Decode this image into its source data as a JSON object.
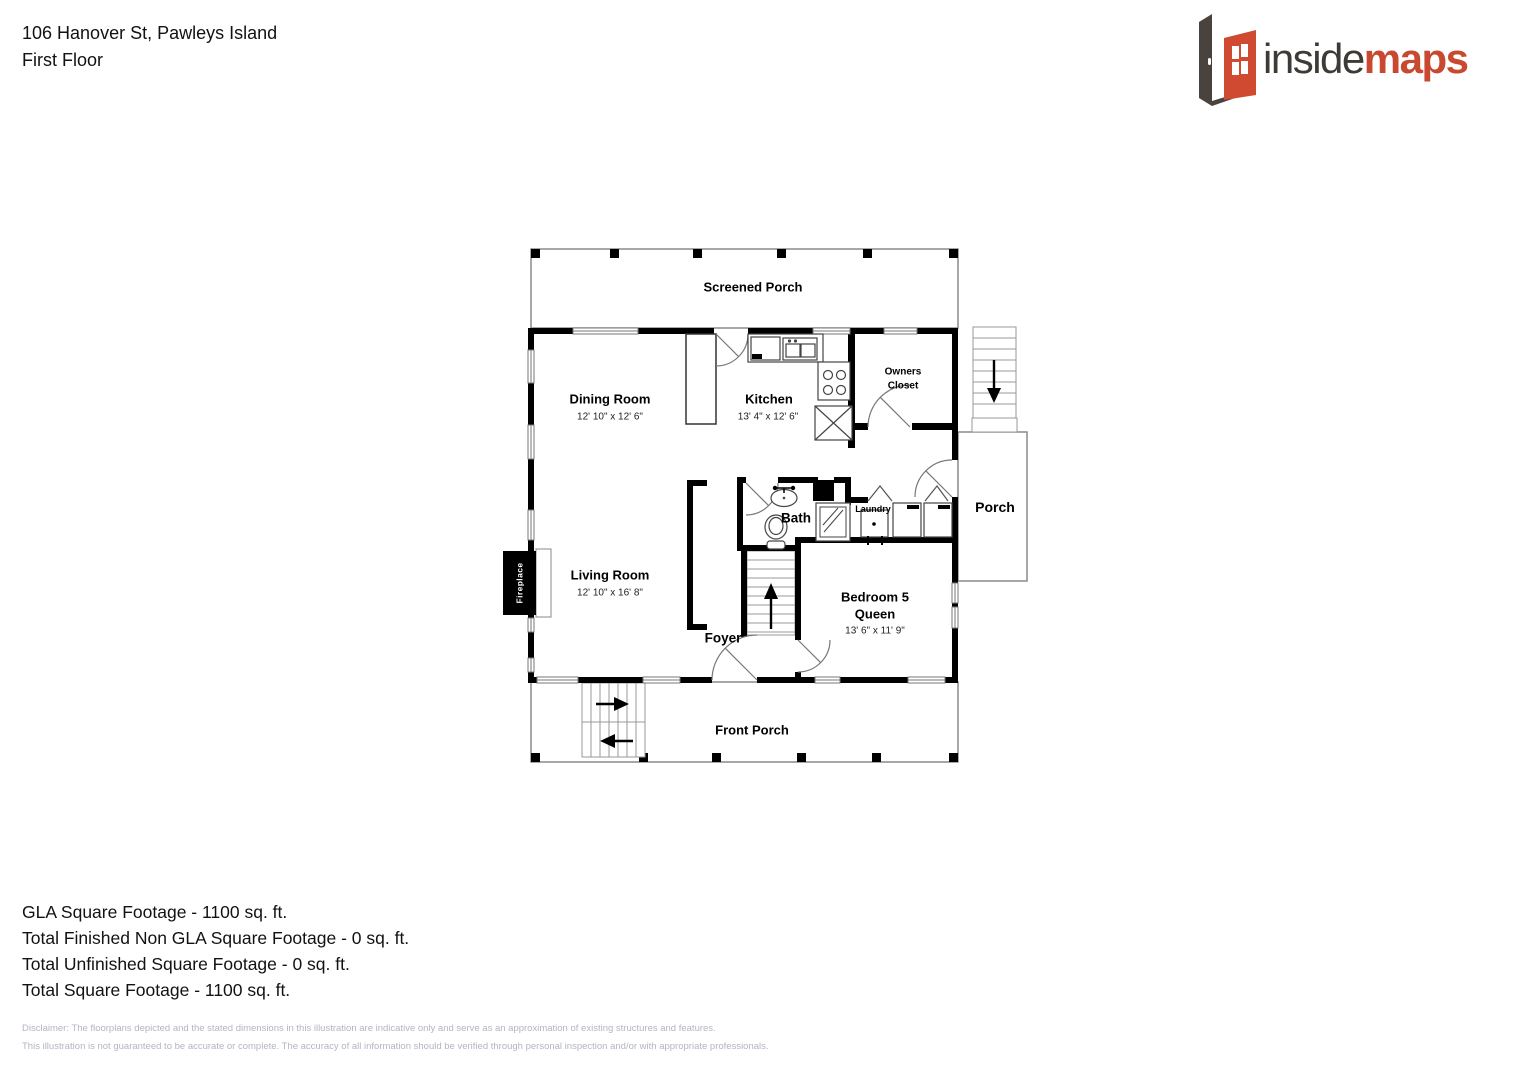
{
  "header": {
    "address": "106 Hanover St, Pawleys Island",
    "floor_label": "First Floor"
  },
  "logo": {
    "word_inside": "inside",
    "word_maps": "maps",
    "frame_color": "#4a423d",
    "door_color": "#d04a32",
    "inside_color": "#3e3a36",
    "maps_color": "#c8492f"
  },
  "rooms": {
    "screened_porch": {
      "name": "Screened Porch"
    },
    "dining": {
      "name": "Dining Room",
      "dims": "12' 10\" x 12' 6\""
    },
    "kitchen": {
      "name": "Kitchen",
      "dims": "13' 4\" x 12' 6\""
    },
    "owners_closet": {
      "line1": "Owners",
      "line2": "Closet"
    },
    "side_porch": {
      "name": "Porch"
    },
    "bath": {
      "name": "Bath"
    },
    "laundry": {
      "name": "Laundry"
    },
    "living": {
      "name": "Living Room",
      "dims": "12' 10\" x 16' 8\""
    },
    "foyer": {
      "name": "Foyer"
    },
    "bedroom5": {
      "name": "Bedroom 5",
      "bed": "Queen",
      "dims": "13' 6\" x 11' 9\""
    },
    "front_porch": {
      "name": "Front Porch"
    },
    "fireplace": {
      "name": "Fireplace"
    }
  },
  "summary": {
    "gla": "GLA Square Footage - 1100 sq. ft.",
    "non_gla": "Total Finished Non GLA Square Footage - 0 sq. ft.",
    "unfinished": "Total Unfinished Square Footage - 0 sq. ft.",
    "total": "Total Square Footage - 1100 sq. ft."
  },
  "disclaimer": {
    "line1": "Disclaimer: The floorplans depicted and the stated dimensions in this illustration are indicative only and serve as an approximation of existing structures and features.",
    "line2": "This illustration is not guaranteed to be accurate or complete. The accuracy of all information should be verified through personal inspection and/or with appropriate professionals."
  }
}
